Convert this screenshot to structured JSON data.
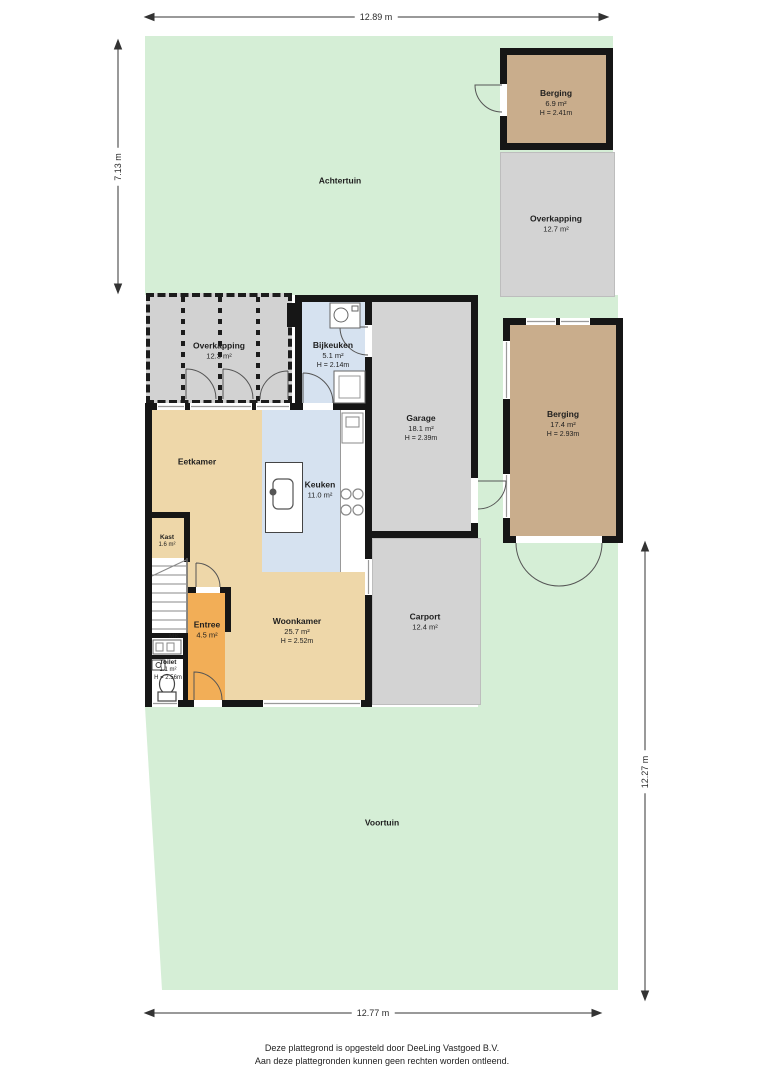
{
  "dimensions": {
    "top": "12.89 m",
    "left": "7.13 m",
    "right": "12.27 m",
    "bottom": "12.77 m"
  },
  "gardens": {
    "achtertuin": "Achtertuin",
    "voortuin": "Voortuin"
  },
  "rooms": {
    "berging_top": {
      "name": "Berging",
      "area": "6.9 m²",
      "height": "H = 2.41m"
    },
    "overkapping_right": {
      "name": "Overkapping",
      "area": "12.7 m²"
    },
    "overkapping_left": {
      "name": "Overkapping",
      "area": "12.3 m²"
    },
    "bijkeuken": {
      "name": "Bijkeuken",
      "area": "5.1 m²",
      "height": "H = 2.14m"
    },
    "garage": {
      "name": "Garage",
      "area": "18.1 m²",
      "height": "H = 2.39m"
    },
    "berging_right": {
      "name": "Berging",
      "area": "17.4 m²",
      "height": "H = 2.93m"
    },
    "eetkamer": {
      "name": "Eetkamer"
    },
    "keuken": {
      "name": "Keuken",
      "area": "11.0 m²"
    },
    "kast": {
      "name": "Kast",
      "area": "1.6 m²"
    },
    "entree": {
      "name": "Entree",
      "area": "4.5 m²"
    },
    "mk": {
      "name": "MK"
    },
    "toilet": {
      "name": "Toilet",
      "area": "1.1 m²",
      "height": "H = 2.56m"
    },
    "woonkamer": {
      "name": "Woonkamer",
      "area": "25.7 m²",
      "height": "H = 2.52m"
    },
    "carport": {
      "name": "Carport",
      "area": "12.4 m²"
    }
  },
  "footer": {
    "line1": "Deze plattegrond is opgesteld door DeeLing Vastgoed B.V.",
    "line2": "Aan deze plattegronden kunnen geen rechten worden ontleend."
  },
  "colors": {
    "garden_green": "#d5eed6",
    "room_tan": "#eed7a9",
    "berging_tan": "#c9ad8c",
    "room_blue": "#d6e2f0",
    "room_gray": "#d3d3d3",
    "entree_orange": "#f2ae57",
    "wall_black": "#161616"
  }
}
